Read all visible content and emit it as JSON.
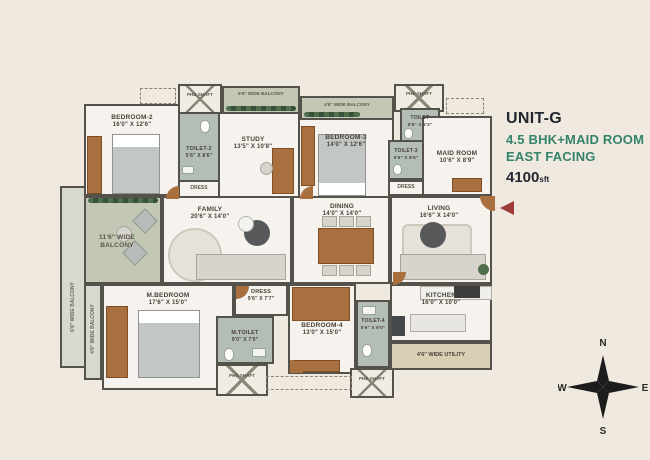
{
  "header": {
    "unit": "UNIT-G",
    "config": "4.5 BHK+MAID ROOM",
    "facing": "EAST FACING",
    "area": "4100",
    "area_unit": "sft"
  },
  "colors": {
    "background": "#EFE9DF",
    "title_dark": "#23272F",
    "title_green": "#35836A",
    "entry_arrow": "#9D3B34",
    "wall": "#55514B",
    "balcony_floor": "#C2C8B4",
    "toilet_floor": "#B3BFB6",
    "wood": "#A96F3E"
  },
  "plan": {
    "rooms": {
      "bedroom2": {
        "name": "BEDROOM-2",
        "dims": "16'0\" X 12'6\""
      },
      "toilet2": {
        "name": "TOILET-2",
        "dims": "5'6\" X 8'6\""
      },
      "dress2": {
        "name": "DRESS"
      },
      "study": {
        "name": "STUDY",
        "dims": "13'5\" X 10'8\""
      },
      "bedroom3": {
        "name": "BEDROOM-3",
        "dims": "14'0\" X 12'6\""
      },
      "toilet3": {
        "name": "TOILET-3",
        "dims": "5'6\" X 8'6\""
      },
      "dress3": {
        "name": "DRESS"
      },
      "toilet": {
        "name": "TOILET",
        "dims": "5'5\" X 4'3\""
      },
      "maidroom": {
        "name": "MAID ROOM",
        "dims": "10'6\" X 8'9\""
      },
      "family": {
        "name": "FAMILY",
        "dims": "20'6\" X 14'0\""
      },
      "dining": {
        "name": "DINING",
        "dims": "14'0\" X 14'0\""
      },
      "living": {
        "name": "LIVING",
        "dims": "16'6\" X 14'0\""
      },
      "mbedroom": {
        "name": "M.BEDROOM",
        "dims": "17'6\" X 15'0\""
      },
      "mdress": {
        "name": "DRESS",
        "dims": "9'6\" X 7'7\""
      },
      "mtoilet": {
        "name": "M.TOILET",
        "dims": "9'0\" X 7'0\""
      },
      "bedroom4": {
        "name": "BEDROOM-4",
        "dims": "13'0\" X 15'0\""
      },
      "toilet4": {
        "name": "TOILET-4",
        "dims": "5'6\" X 9'0\""
      },
      "kitchen": {
        "name": "KITCHEN",
        "dims": "16'0\" X 10'0\""
      }
    },
    "balconies": {
      "top1": "6'6\" WIDE BALCONY",
      "top2": "4'6\" WIDE BALCONY",
      "left": "11'6\" WIDE BALCONY",
      "side1": "6'6\" WIDE BALCONY",
      "side2": "4'6\" WIDE BALCONY",
      "utility": "4'6\" WIDE UTILITY"
    },
    "shaft_label": "PHE SHAFT"
  },
  "compass": {
    "n": "N",
    "e": "E",
    "s": "S",
    "w": "W"
  }
}
